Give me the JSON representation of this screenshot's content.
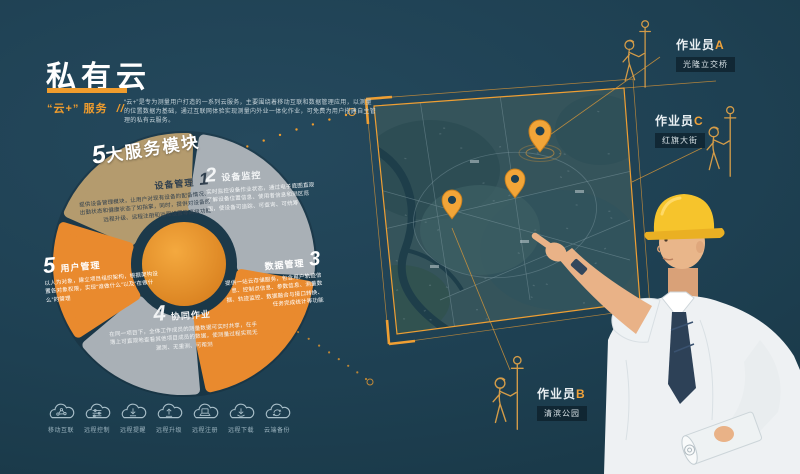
{
  "header": {
    "title": "私有云",
    "service_prefix": "“云+”",
    "service_suffix": "服务",
    "slashes": "//",
    "description": "“云+”是专为测量用户打造的一系列云服务，主要围绕着移动互联和数据管理应用，以测量的位置数据为基础，通过互联网体验实现测量内外业一体化作业，可免费为用户搭建自主管理的私有云服务。"
  },
  "modules_header": {
    "num": "5",
    "text": "大服务模块"
  },
  "modules": [
    {
      "num": "1",
      "title": "设备管理",
      "color": "#b49b6e",
      "desc": "提供设备管理模块，让用户对现有设备的配备情况、出勤状态和健康状态了如指掌，同时，提供对设备的远程升级、远程注册和远程设置等高级功能"
    },
    {
      "num": "2",
      "title": "设备监控",
      "color": "#a9b0b6",
      "desc": "实时监控设备作业状态，通过电子底图直观了解设备位置信息、使用者信息和测区范围，使设备可追踪、可查询、可统筹"
    },
    {
      "num": "3",
      "title": "数据管理",
      "color": "#e98a2e",
      "desc": "提供一站云存储服务，包含用户轨迹信息、控制点信息、参数信息、测量数据、轨迹监控、数据融合与接口转换、任务完成统计等功能"
    },
    {
      "num": "4",
      "title": "协同作业",
      "color": "#a9b0b6",
      "desc": "在同一项目下，全体工作成员的测量数据可实时共享，在手簿上可直观地查看其他项目成员的数据，使测量过程实现无漏测、无重测、可帮测"
    },
    {
      "num": "5",
      "title": "用户管理",
      "color": "#e98a2e",
      "desc": "以人为对象，建立项目组织架构，根据架构设置各对象权限，实现“谁做什么”以及“在做什么”的管理"
    }
  ],
  "workers": [
    {
      "name": "作业员",
      "letter": "A",
      "location": "光隆立交桥"
    },
    {
      "name": "作业员",
      "letter": "C",
      "location": "红旗大街"
    },
    {
      "name": "作业员",
      "letter": "B",
      "location": "清滨公园"
    }
  ],
  "map": {
    "pin_color": "#f2a538",
    "pin_count": 3
  },
  "footer": {
    "items": [
      {
        "label": "移动互联",
        "icon": "mobile-internet-icon"
      },
      {
        "label": "远程控制",
        "icon": "remote-control-icon"
      },
      {
        "label": "远程提醒",
        "icon": "remote-reminder-icon"
      },
      {
        "label": "远程升级",
        "icon": "remote-upgrade-icon"
      },
      {
        "label": "远程注册",
        "icon": "remote-register-icon"
      },
      {
        "label": "远程下载",
        "icon": "remote-download-icon"
      },
      {
        "label": "云端备份",
        "icon": "cloud-backup-icon"
      }
    ]
  },
  "colors": {
    "accent": "#ef9c2d",
    "wedge_tan": "#b49b6e",
    "wedge_gray": "#a9b0b6",
    "wedge_orange": "#e98a2e",
    "background": "#1d4053"
  }
}
